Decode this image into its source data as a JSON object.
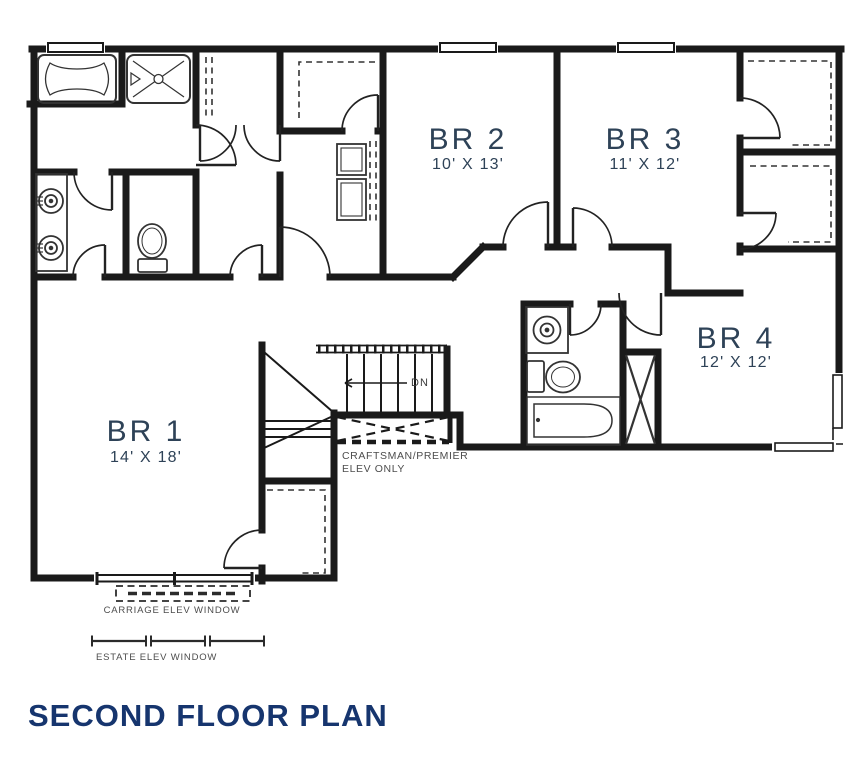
{
  "title": "SECOND FLOOR PLAN",
  "colors": {
    "title": "#16356e",
    "room_label": "#2e4257",
    "annotation": "#4d4d4d",
    "wall": "#1a1a1a"
  },
  "rooms": {
    "br1": {
      "name": "BR 1",
      "dims": "14' X 18'"
    },
    "br2": {
      "name": "BR 2",
      "dims": "10' X 13'"
    },
    "br3": {
      "name": "BR 3",
      "dims": "11' X 12'"
    },
    "br4": {
      "name": "BR 4",
      "dims": "12' X 12'"
    }
  },
  "annotations": {
    "stairs_direction": "DN",
    "elev_note_line1": "CRAFTSMAN/PREMIER",
    "elev_note_line2": "ELEV ONLY",
    "carriage_window": "CARRIAGE ELEV WINDOW",
    "estate_window": "ESTATE ELEV WINDOW"
  }
}
